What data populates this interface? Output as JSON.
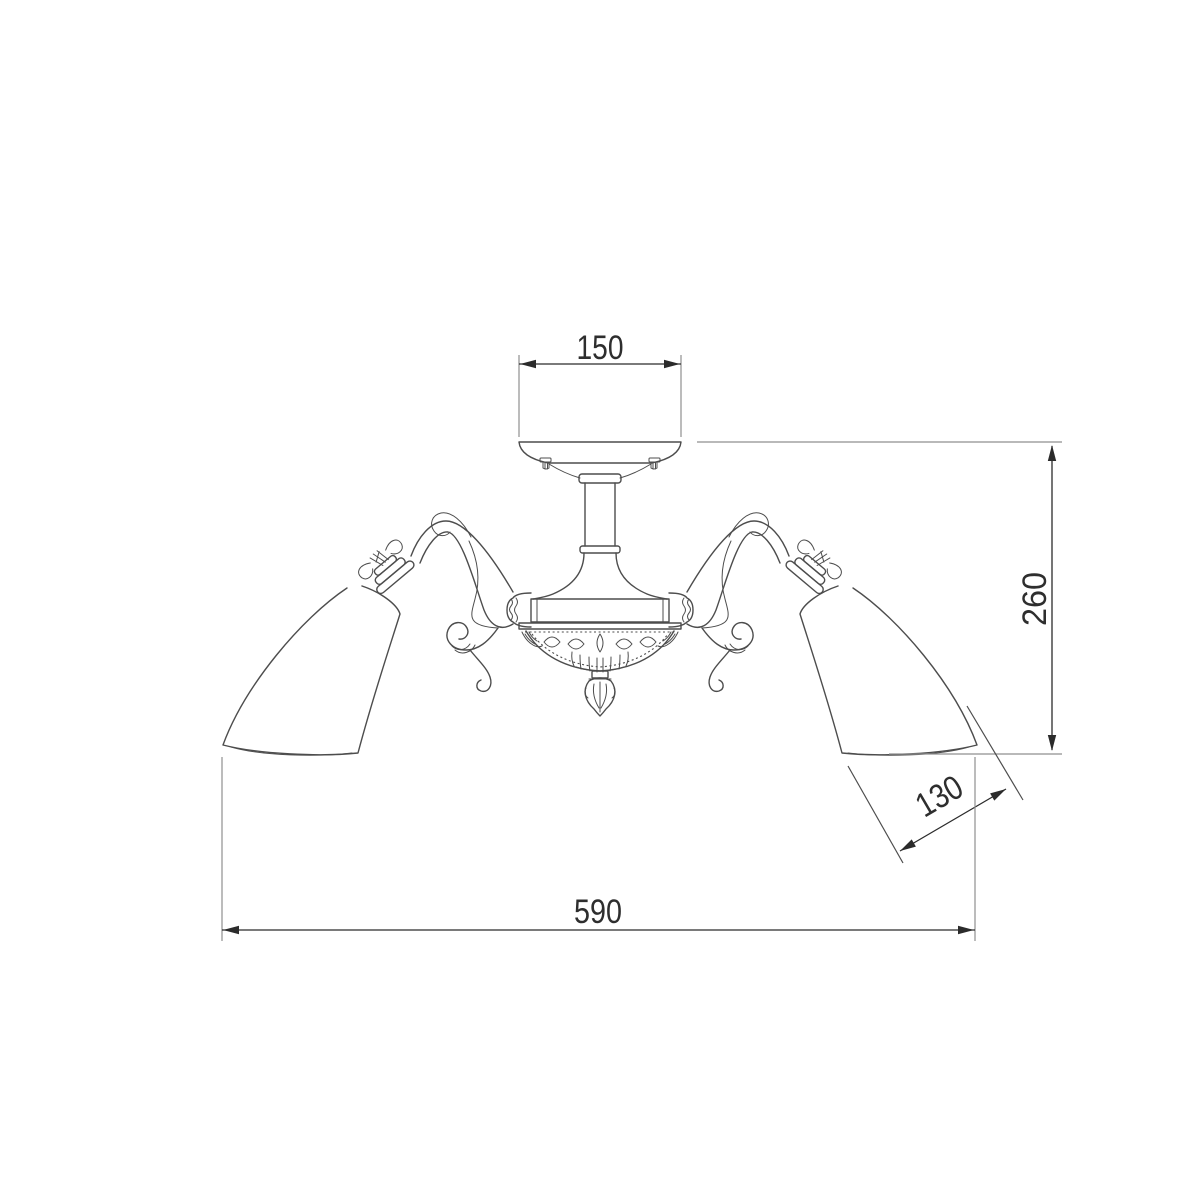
{
  "drawing": {
    "dimensions": {
      "canopy_width": "150",
      "fixture_height": "260",
      "shade_diameter": "130",
      "overall_width": "590"
    }
  },
  "colors": {
    "background": "#ffffff",
    "fixture_stroke": "#4d4d4d",
    "dimension_stroke": "#2b2b2b",
    "extension_stroke": "#8f8f8f",
    "label_text": "#2e2e2e"
  }
}
